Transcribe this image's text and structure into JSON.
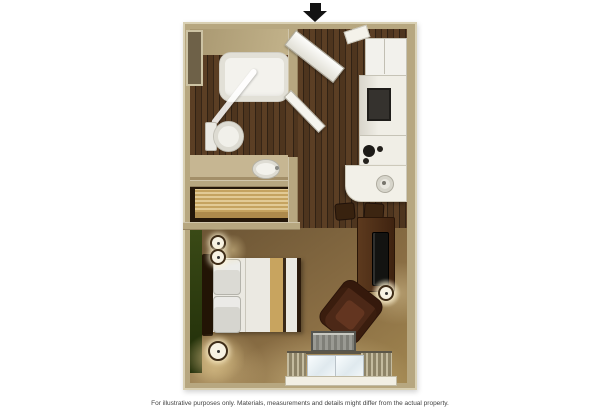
{
  "meta": {
    "type": "floor-plan",
    "view": "top-down-3d"
  },
  "caption": {
    "disclaimer": "For illustrative purposes only.  Materials, measurements and details might differ from the actual property."
  },
  "icons": {
    "entrance_arrow": "down-arrow"
  },
  "palette": {
    "background": "#ffffff",
    "wall_tan": "#b7a780",
    "wall_edge_light": "#d9d0b3",
    "wood_floor_dark": "#46311d",
    "carpet_brown": "#8a6e44",
    "accent_wall_green": "#33420f",
    "fixture_white": "#f2f1ec",
    "furniture_dark_brown": "#3f2310",
    "appliance_black": "#24211d",
    "closet_wood_light": "#d8b872",
    "heater_gray": "#8d8d86"
  },
  "rooms": {
    "bathroom": "bathroom",
    "closet": "closet",
    "entry": "entry-hall",
    "kitchen": "kitchenette",
    "living": "studio-bedroom-living"
  }
}
